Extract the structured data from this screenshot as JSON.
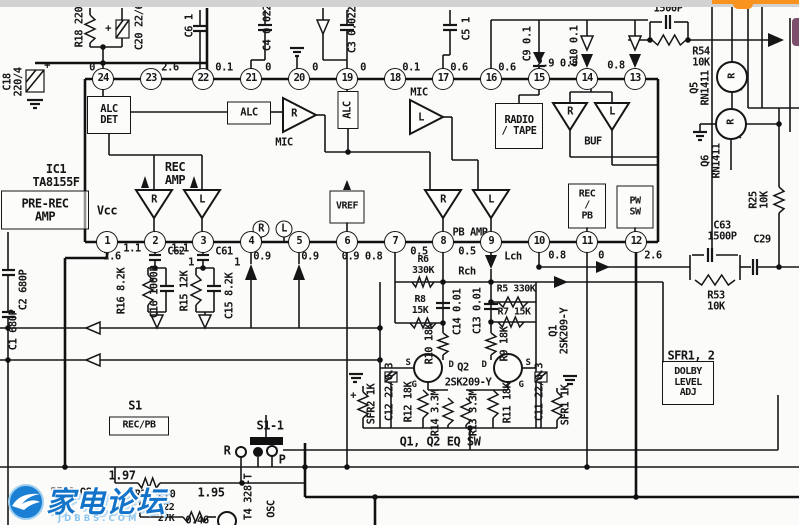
{
  "watermark": {
    "text": "家电论坛",
    "subtext": "JDBBS.COM",
    "color": "#1273c8",
    "sub_color": "#8ec6ef"
  },
  "overlay": {
    "top_bar_color": "#f7931e",
    "side_tab_color": "#7d4f6d",
    "scan_edge_color": "#d2d2d2"
  },
  "labels": [
    {
      "n": "r18-label",
      "t": "R18 220",
      "x": 80,
      "y": 27,
      "k": "v"
    },
    {
      "n": "c20-label",
      "t": "C20 22/6",
      "x": 140,
      "y": 27,
      "k": "v"
    },
    {
      "n": "c20-plus",
      "t": "+",
      "x": 108,
      "y": 29,
      "k": "t"
    },
    {
      "n": "c18-label",
      "t": "C18\n220/4",
      "x": 14,
      "y": 82,
      "k": "v"
    },
    {
      "n": "c18-plus",
      "t": "+",
      "x": 47,
      "y": 66,
      "k": "t"
    },
    {
      "n": "c6-label",
      "t": "C6 1",
      "x": 190,
      "y": 26,
      "k": "v"
    },
    {
      "n": "c4-label",
      "t": "C4 0.022",
      "x": 268,
      "y": 28,
      "k": "v"
    },
    {
      "n": "c3-label",
      "t": "C3 0.022",
      "x": 353,
      "y": 30,
      "k": "v"
    },
    {
      "n": "c5-label",
      "t": "C5 1",
      "x": 467,
      "y": 29,
      "k": "v"
    },
    {
      "n": "c9-label",
      "t": "C9 0.1",
      "x": 528,
      "y": 44,
      "k": "v"
    },
    {
      "n": "c10-label",
      "t": "C10 0.1",
      "x": 575,
      "y": 46,
      "k": "v"
    },
    {
      "n": "cap-1500p-label",
      "t": "1500P",
      "x": 668,
      "y": 9,
      "k": "t"
    },
    {
      "n": "r54-label",
      "t": "R54\n10K",
      "x": 701,
      "y": 58,
      "k": "t"
    },
    {
      "n": "q5-label",
      "t": "Q5\nRN1411",
      "x": 701,
      "y": 88,
      "k": "v"
    },
    {
      "n": "q6-label",
      "t": "Q6\nRN1411",
      "x": 712,
      "y": 161,
      "k": "v"
    },
    {
      "n": "r25-label",
      "t": "R25\n10K",
      "x": 760,
      "y": 200,
      "k": "v"
    },
    {
      "n": "c63-label",
      "t": "C63\n1500P",
      "x": 722,
      "y": 232,
      "k": "t"
    },
    {
      "n": "c29-label",
      "t": "C29",
      "x": 762,
      "y": 240,
      "k": "t"
    },
    {
      "n": "r53-label",
      "t": "R53\n10K",
      "x": 716,
      "y": 302,
      "k": "t"
    },
    {
      "n": "pin24-value",
      "t": "0",
      "x": 92,
      "y": 68,
      "k": "t"
    },
    {
      "n": "pin23-value",
      "t": "2.6",
      "x": 170,
      "y": 68,
      "k": "t"
    },
    {
      "n": "pin22-value",
      "t": "0.1",
      "x": 224,
      "y": 68,
      "k": "t"
    },
    {
      "n": "pin21-value",
      "t": "0",
      "x": 268,
      "y": 68,
      "k": "t"
    },
    {
      "n": "pin20-value",
      "t": "0",
      "x": 315,
      "y": 68,
      "k": "t"
    },
    {
      "n": "pin19-value",
      "t": "0",
      "x": 363,
      "y": 68,
      "k": "t"
    },
    {
      "n": "pin18-value",
      "t": "0.1",
      "x": 411,
      "y": 68,
      "k": "t"
    },
    {
      "n": "pin17-value",
      "t": "0.6",
      "x": 459,
      "y": 68,
      "k": "t"
    },
    {
      "n": "pin16-value",
      "t": "0.6",
      "x": 507,
      "y": 68,
      "k": "t"
    },
    {
      "n": "pin15-14-value",
      "t": "2.9 0.8",
      "x": 557,
      "y": 64,
      "k": "t"
    },
    {
      "n": "pin13-value",
      "t": "0.8",
      "x": 616,
      "y": 66,
      "k": "t"
    },
    {
      "n": "alc-det-box",
      "t": "ALC\nDET",
      "x": 109,
      "y": 115,
      "k": "b",
      "w": 42,
      "h": 36
    },
    {
      "n": "alc-box",
      "t": "ALC",
      "x": 249,
      "y": 113,
      "k": "b",
      "w": 42,
      "h": 21
    },
    {
      "n": "mic-r-label",
      "t": "MIC",
      "x": 284,
      "y": 143,
      "k": "t"
    },
    {
      "n": "amp-mic-r-letter",
      "t": "R",
      "x": 294,
      "y": 114,
      "k": "t"
    },
    {
      "n": "alc-vbox",
      "t": "ALC",
      "x": 348,
      "y": 110,
      "k": "vb",
      "w": 36,
      "h": 19
    },
    {
      "n": "mic-l-label",
      "t": "MIC",
      "x": 419,
      "y": 93,
      "k": "t"
    },
    {
      "n": "amp-mic-l-letter",
      "t": "L",
      "x": 421,
      "y": 118,
      "k": "t"
    },
    {
      "n": "radio-tape-box",
      "t": "RADIO\n/ TAPE",
      "x": 519,
      "y": 126,
      "k": "b",
      "w": 46,
      "h": 44
    },
    {
      "n": "buf-r-letter",
      "t": "R",
      "x": 570,
      "y": 112,
      "k": "t"
    },
    {
      "n": "buf-l-letter",
      "t": "L",
      "x": 612,
      "y": 112,
      "k": "t"
    },
    {
      "n": "buf-label",
      "t": "BUF",
      "x": 593,
      "y": 142,
      "k": "t"
    },
    {
      "n": "ic1-label",
      "t": "IC1\nTA8155F",
      "x": 56,
      "y": 176,
      "k": "t",
      "fs": 12
    },
    {
      "n": "pre-rec-amp-box",
      "t": "PRE-REC\nAMP",
      "x": 45,
      "y": 210,
      "k": "b",
      "w": 86,
      "h": 37,
      "fs": 12
    },
    {
      "n": "rec-amp-label",
      "t": "REC\nAMP",
      "x": 175,
      "y": 174,
      "k": "t",
      "fs": 12
    },
    {
      "n": "rec-r-letter",
      "t": "R",
      "x": 154,
      "y": 200,
      "k": "t"
    },
    {
      "n": "rec-l-letter",
      "t": "L",
      "x": 202,
      "y": 200,
      "k": "t"
    },
    {
      "n": "vcc-label",
      "t": "Vcc",
      "x": 107,
      "y": 211,
      "k": "t",
      "fs": 12
    },
    {
      "n": "vref-box",
      "t": "VREF",
      "x": 347,
      "y": 207,
      "k": "b",
      "w": 33,
      "h": 31,
      "fs": 10
    },
    {
      "n": "pb-r-letter",
      "t": "R",
      "x": 443,
      "y": 200,
      "k": "t"
    },
    {
      "n": "pb-l-letter",
      "t": "L",
      "x": 491,
      "y": 200,
      "k": "t"
    },
    {
      "n": "pb-amp-label",
      "t": "PB AMP",
      "x": 470,
      "y": 233,
      "k": "t"
    },
    {
      "n": "rec-pb-box",
      "t": "REC\n/\nPB",
      "x": 587,
      "y": 206,
      "k": "b",
      "w": 36,
      "h": 43,
      "fs": 10
    },
    {
      "n": "pw-sw-box",
      "t": "PW\nSW",
      "x": 635,
      "y": 207,
      "k": "b",
      "w": 35,
      "h": 41,
      "fs": 10
    },
    {
      "n": "circled-r",
      "t": "R",
      "x": 261,
      "y": 229,
      "k": "c"
    },
    {
      "n": "circled-l",
      "t": "L",
      "x": 284,
      "y": 229,
      "k": "c"
    },
    {
      "n": "q5-inner-letter",
      "t": "R",
      "x": 733,
      "y": 76,
      "k": "v",
      "fs": 10
    },
    {
      "n": "q6-inner-letter",
      "t": "R",
      "x": 732,
      "y": 122,
      "k": "v",
      "fs": 10
    },
    {
      "n": "c2-label",
      "t": "C2 680P",
      "x": 24,
      "y": 290,
      "k": "v"
    },
    {
      "n": "c1-label",
      "t": "C1 680P",
      "x": 14,
      "y": 330,
      "k": "v"
    },
    {
      "n": "pin1-value",
      "t": "2.6",
      "x": 112,
      "y": 257,
      "k": "t"
    },
    {
      "n": "pin1-2-value",
      "t": "1.1",
      "x": 132,
      "y": 249,
      "k": "t"
    },
    {
      "n": "pin2-3-value",
      "t": "1.1",
      "x": 180,
      "y": 249,
      "k": "t"
    },
    {
      "n": "pin4-value",
      "t": "0.9",
      "x": 262,
      "y": 257,
      "k": "t"
    },
    {
      "n": "pin5-value",
      "t": "0.9",
      "x": 310,
      "y": 257,
      "k": "t"
    },
    {
      "n": "pin6-value",
      "t": "0.9 0.8",
      "x": 362,
      "y": 257,
      "k": "t"
    },
    {
      "n": "pin7-value",
      "t": "0.5",
      "x": 419,
      "y": 252,
      "k": "t"
    },
    {
      "n": "pin8-value",
      "t": "0.5",
      "x": 467,
      "y": 252,
      "k": "t"
    },
    {
      "n": "pin9-value",
      "t": "Lch",
      "x": 513,
      "y": 257,
      "k": "t"
    },
    {
      "n": "pin10-value",
      "t": "0.8",
      "x": 557,
      "y": 256,
      "k": "t"
    },
    {
      "n": "pin11-value",
      "t": "0",
      "x": 601,
      "y": 256,
      "k": "t"
    },
    {
      "n": "pin12-value",
      "t": "2.6",
      "x": 653,
      "y": 256,
      "k": "t"
    },
    {
      "n": "c62-label",
      "t": "C62",
      "x": 176,
      "y": 252,
      "k": "t"
    },
    {
      "n": "c62-value",
      "t": "1",
      "x": 191,
      "y": 263,
      "k": "t"
    },
    {
      "n": "c61-label",
      "t": "C61",
      "x": 224,
      "y": 252,
      "k": "t"
    },
    {
      "n": "c61-value",
      "t": "1",
      "x": 237,
      "y": 263,
      "k": "t"
    },
    {
      "n": "r16-label",
      "t": "R16 8.2K",
      "x": 122,
      "y": 291,
      "k": "v"
    },
    {
      "n": "c16-label",
      "t": "C16 1000P",
      "x": 155,
      "y": 292,
      "k": "v"
    },
    {
      "n": "r15-label",
      "t": "R15 12K",
      "x": 185,
      "y": 291,
      "k": "v"
    },
    {
      "n": "c15-label",
      "t": "C15 8.2K",
      "x": 230,
      "y": 296,
      "k": "v"
    },
    {
      "n": "r6-label",
      "t": "R6\n330K",
      "x": 423,
      "y": 266,
      "k": "t",
      "fs": 10
    },
    {
      "n": "rch-label",
      "t": "Rch",
      "x": 467,
      "y": 272,
      "k": "t"
    },
    {
      "n": "r8-label",
      "t": "R8\n15K",
      "x": 420,
      "y": 306,
      "k": "t",
      "fs": 10
    },
    {
      "n": "c14-label",
      "t": "C14 0.01",
      "x": 458,
      "y": 312,
      "k": "v"
    },
    {
      "n": "c13-label",
      "t": "C13 0.01",
      "x": 478,
      "y": 311,
      "k": "v"
    },
    {
      "n": "r5-label",
      "t": "R5 330K",
      "x": 516,
      "y": 290,
      "k": "t",
      "fs": 10
    },
    {
      "n": "r7-label",
      "t": "R7 15K",
      "x": 514,
      "y": 313,
      "k": "t",
      "fs": 10
    },
    {
      "n": "r10-label",
      "t": "R10 18K",
      "x": 430,
      "y": 344,
      "k": "v"
    },
    {
      "n": "r9-label",
      "t": "R9 18K",
      "x": 505,
      "y": 344,
      "k": "v"
    },
    {
      "n": "q2-s-label",
      "t": "S",
      "x": 408,
      "y": 364,
      "k": "t",
      "fs": 9
    },
    {
      "n": "q2-d-label",
      "t": "D",
      "x": 451,
      "y": 366,
      "k": "t",
      "fs": 9
    },
    {
      "n": "q2-g-label",
      "t": "G",
      "x": 414,
      "y": 386,
      "k": "t",
      "fs": 9
    },
    {
      "n": "q2-label",
      "t": "Q2",
      "x": 463,
      "y": 368,
      "k": "t"
    },
    {
      "n": "q2-part-label",
      "t": "2SK209-Y",
      "x": 468,
      "y": 383,
      "k": "t"
    },
    {
      "n": "q1-d-label",
      "t": "D",
      "x": 484,
      "y": 366,
      "k": "t",
      "fs": 9
    },
    {
      "n": "q1-s-label",
      "t": "S",
      "x": 528,
      "y": 364,
      "k": "t",
      "fs": 9
    },
    {
      "n": "q1-g-label",
      "t": "G",
      "x": 521,
      "y": 386,
      "k": "t",
      "fs": 9
    },
    {
      "n": "q1-label",
      "t": "Q1\n2SK209-Y",
      "x": 560,
      "y": 331,
      "k": "v"
    },
    {
      "n": "sfr2-label",
      "t": "SFR2 1K",
      "x": 372,
      "y": 404,
      "k": "v"
    },
    {
      "n": "sfr2-plus",
      "t": "+",
      "x": 353,
      "y": 396,
      "k": "t"
    },
    {
      "n": "c12-label",
      "t": "C12 22/6.3",
      "x": 390,
      "y": 392,
      "k": "v"
    },
    {
      "n": "r12-label",
      "t": "R12 18K",
      "x": 409,
      "y": 402,
      "k": "v"
    },
    {
      "n": "r14-label",
      "t": "R14 3.3M",
      "x": 436,
      "y": 413,
      "k": "v"
    },
    {
      "n": "r13-label",
      "t": "R13 3.3M",
      "x": 474,
      "y": 413,
      "k": "v"
    },
    {
      "n": "r11-label",
      "t": "R11 18K",
      "x": 508,
      "y": 403,
      "k": "v"
    },
    {
      "n": "c11-label",
      "t": "C11 22/6.3",
      "x": 540,
      "y": 392,
      "k": "v"
    },
    {
      "n": "sfr1-label",
      "t": "SFR1 1K",
      "x": 566,
      "y": 405,
      "k": "v"
    },
    {
      "n": "eq-sw-label",
      "t": "Q1, Q2 EQ SW",
      "x": 440,
      "y": 442,
      "k": "t",
      "fs": 12
    },
    {
      "n": "sfr12-label",
      "t": "SFR1, 2",
      "x": 691,
      "y": 356,
      "k": "t",
      "fs": 12
    },
    {
      "n": "dolby-box",
      "t": "DOLBY\nLEVEL\nADJ",
      "x": 688,
      "y": 383,
      "k": "b",
      "w": 50,
      "h": 42,
      "fs": 10
    },
    {
      "n": "s1-label",
      "t": "S1",
      "x": 135,
      "y": 406,
      "k": "t",
      "fs": 12
    },
    {
      "n": "s1-recpb-box",
      "t": "REC/PB",
      "x": 139,
      "y": 426,
      "k": "b",
      "w": 58,
      "h": 17,
      "fs": 10
    },
    {
      "n": "s1-1-label",
      "t": "S1-1",
      "x": 270,
      "y": 426,
      "k": "t",
      "fs": 12
    },
    {
      "n": "switch-r-label",
      "t": "R",
      "x": 227,
      "y": 451,
      "k": "t",
      "fs": 12
    },
    {
      "n": "switch-p-label",
      "t": "P",
      "x": 282,
      "y": 460,
      "k": "t",
      "fs": 12
    },
    {
      "n": "value-197",
      "t": "1.97",
      "x": 122,
      "y": 476,
      "k": "t",
      "fs": 12
    },
    {
      "n": "r21-label",
      "t": "R21 270",
      "x": 155,
      "y": 495,
      "k": "t"
    },
    {
      "n": "value-195",
      "t": "1.95",
      "x": 211,
      "y": 493,
      "k": "t",
      "fs": 12
    },
    {
      "n": "bias-osc-label",
      "t": "BIAS OSC",
      "x": 74,
      "y": 493,
      "k": "t"
    },
    {
      "n": "r22-label",
      "t": "R22\n27K",
      "x": 166,
      "y": 514,
      "k": "t",
      "fs": 10
    },
    {
      "n": "value-046",
      "t": "0.46",
      "x": 197,
      "y": 521,
      "k": "t"
    },
    {
      "n": "t4-label",
      "t": "T4 328-T",
      "x": 249,
      "y": 497,
      "k": "v"
    },
    {
      "n": "osc-label",
      "t": "OSC",
      "x": 272,
      "y": 509,
      "k": "v"
    },
    {
      "n": "pin-24",
      "t": "24",
      "x": 103,
      "y": 79,
      "k": "p"
    },
    {
      "n": "pin-23",
      "t": "23",
      "x": 151,
      "y": 79,
      "k": "p"
    },
    {
      "n": "pin-22",
      "t": "22",
      "x": 203,
      "y": 79,
      "k": "p"
    },
    {
      "n": "pin-21",
      "t": "21",
      "x": 251,
      "y": 79,
      "k": "p"
    },
    {
      "n": "pin-20",
      "t": "20",
      "x": 299,
      "y": 79,
      "k": "p"
    },
    {
      "n": "pin-19",
      "t": "19",
      "x": 347,
      "y": 79,
      "k": "p"
    },
    {
      "n": "pin-18",
      "t": "18",
      "x": 395,
      "y": 79,
      "k": "p"
    },
    {
      "n": "pin-17",
      "t": "17",
      "x": 443,
      "y": 79,
      "k": "p"
    },
    {
      "n": "pin-16",
      "t": "16",
      "x": 491,
      "y": 79,
      "k": "p"
    },
    {
      "n": "pin-15",
      "t": "15",
      "x": 539,
      "y": 79,
      "k": "p"
    },
    {
      "n": "pin-14",
      "t": "14",
      "x": 587,
      "y": 79,
      "k": "p"
    },
    {
      "n": "pin-13",
      "t": "13",
      "x": 635,
      "y": 79,
      "k": "p"
    },
    {
      "n": "pin-1",
      "t": "1",
      "x": 107,
      "y": 242,
      "k": "p"
    },
    {
      "n": "pin-2",
      "t": "2",
      "x": 155,
      "y": 242,
      "k": "p"
    },
    {
      "n": "pin-3",
      "t": "3",
      "x": 203,
      "y": 242,
      "k": "p"
    },
    {
      "n": "pin-4",
      "t": "4",
      "x": 251,
      "y": 242,
      "k": "p"
    },
    {
      "n": "pin-5",
      "t": "5",
      "x": 299,
      "y": 242,
      "k": "p"
    },
    {
      "n": "pin-6",
      "t": "6",
      "x": 347,
      "y": 242,
      "k": "p"
    },
    {
      "n": "pin-7",
      "t": "7",
      "x": 395,
      "y": 242,
      "k": "p"
    },
    {
      "n": "pin-8",
      "t": "8",
      "x": 443,
      "y": 242,
      "k": "p"
    },
    {
      "n": "pin-9",
      "t": "9",
      "x": 491,
      "y": 242,
      "k": "p"
    },
    {
      "n": "pin-10",
      "t": "10",
      "x": 539,
      "y": 242,
      "k": "p"
    },
    {
      "n": "pin-11",
      "t": "11",
      "x": 587,
      "y": 242,
      "k": "p"
    },
    {
      "n": "pin-12",
      "t": "12",
      "x": 636,
      "y": 242,
      "k": "p"
    }
  ]
}
